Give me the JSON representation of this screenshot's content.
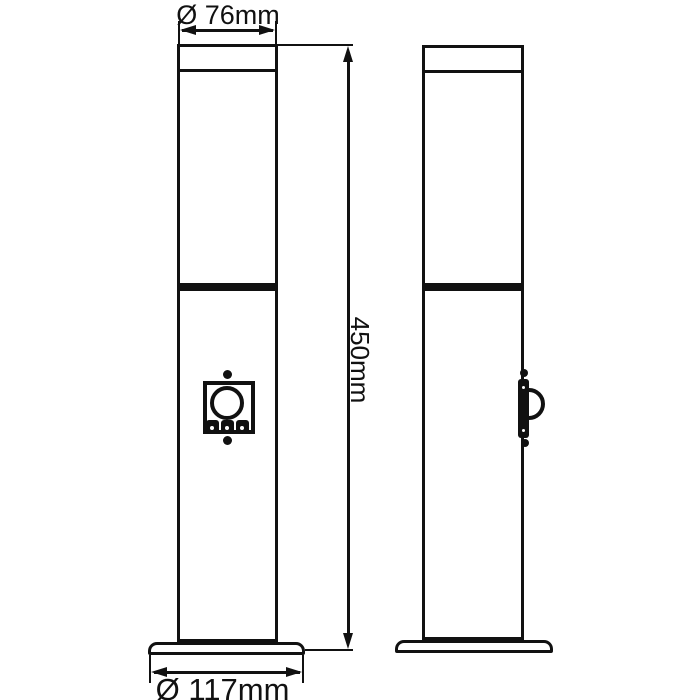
{
  "drawing": {
    "type": "technical-dimension-drawing",
    "subject": "outdoor bollard post light with motion sensor, front and side orthographic views",
    "colors": {
      "line": "#111111",
      "background": "#ffffff"
    },
    "dimensions": {
      "top_diameter": {
        "label": "Ø 76mm",
        "value_mm": 76
      },
      "height": {
        "label": "450mm",
        "value_mm": 450
      },
      "base_diameter": {
        "label": "Ø 117mm",
        "value_mm": 117
      }
    },
    "views": {
      "front": {
        "features": [
          "top-cap-ring",
          "diffuser-tube",
          "mid-joint-band",
          "pir-motion-sensor",
          "base-flange"
        ],
        "sensor_parts": [
          "sensor-plate",
          "sensor-lens-circle",
          "adjustment-knob",
          "adjustment-knob",
          "adjustment-knob",
          "screw-top",
          "screw-bottom"
        ]
      },
      "side": {
        "features": [
          "top-cap-ring",
          "diffuser-tube",
          "mid-joint-band",
          "pir-motion-sensor-profile",
          "base-flange"
        ],
        "sensor_parts": [
          "sensor-bar-profile",
          "sensor-dome-arc",
          "screw-bump-top",
          "screw-bump-bottom"
        ]
      }
    }
  }
}
